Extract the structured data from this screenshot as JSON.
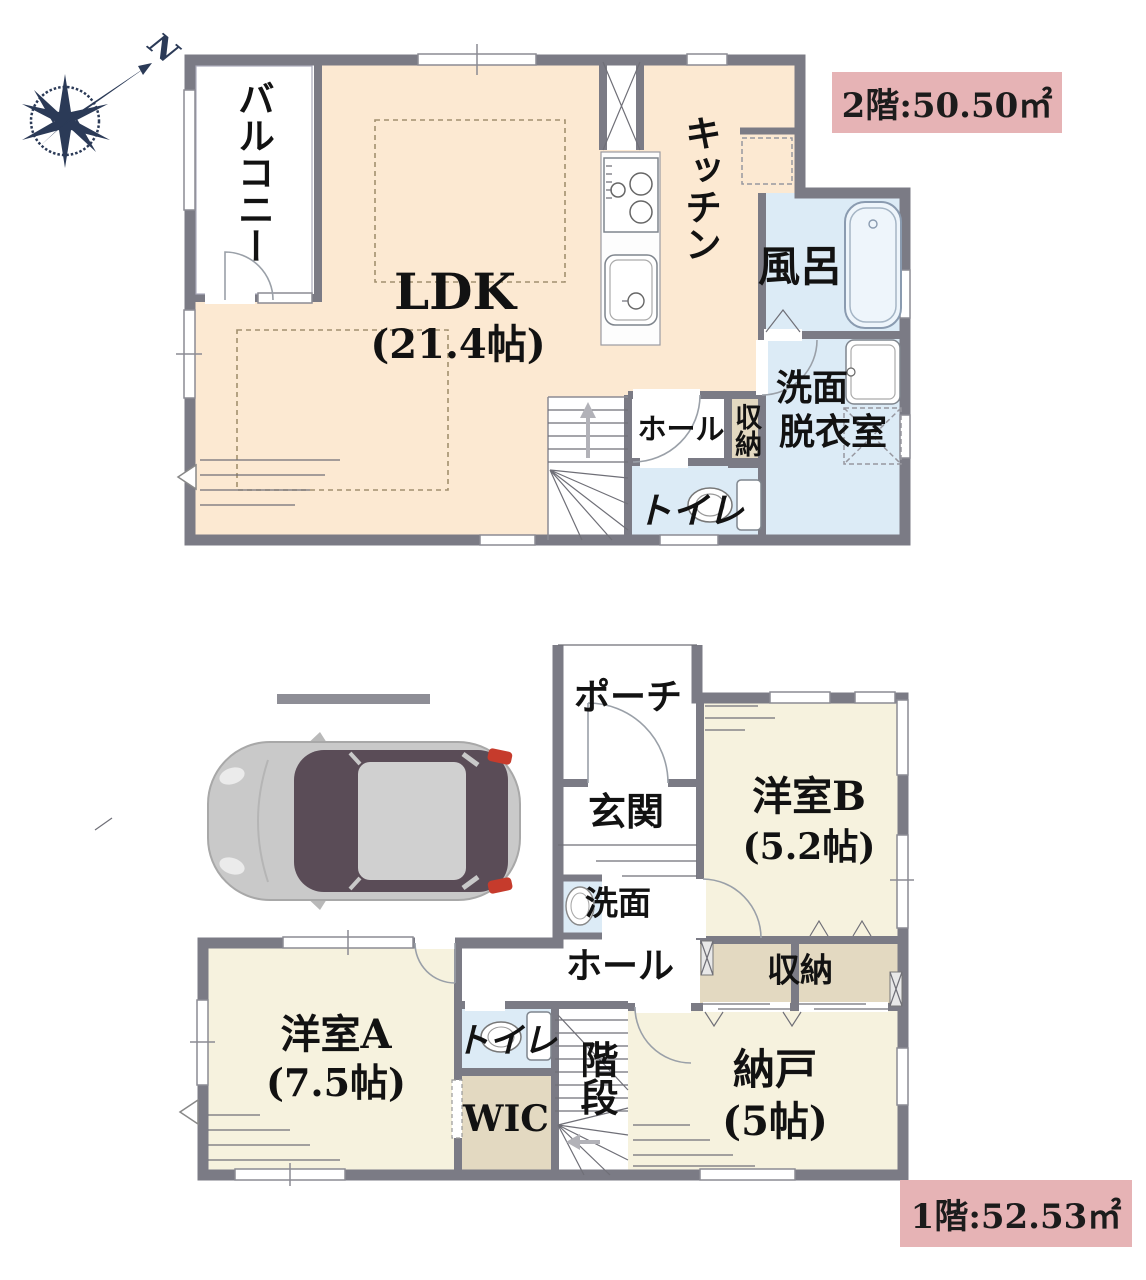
{
  "compass": {
    "north_label": "N"
  },
  "floor2": {
    "area_label": "2階:50.50㎡",
    "balcony": "バルコニー",
    "ldk": "LDK",
    "ldk_size": "(21.4帖)",
    "kitchen": "キッチン",
    "bath": "風呂",
    "washroom_line1": "洗面",
    "washroom_line2": "脱衣室",
    "hall": "ホール",
    "storage": "収納",
    "toilet": "トイレ"
  },
  "floor1": {
    "area_label": "1階:52.53㎡",
    "porch": "ポーチ",
    "entrance": "玄関",
    "washbasin": "洗面",
    "hall": "ホール",
    "room_b": "洋室B",
    "room_b_size": "(5.2帖)",
    "storage": "収納",
    "storeroom": "納戸",
    "storeroom_size": "(5帖)",
    "stairs": "階段",
    "toilet": "トイレ",
    "wic": "WIC",
    "room_a": "洋室A",
    "room_a_size": "(7.5帖)"
  },
  "colors": {
    "wall": "#7b7b85",
    "ldk_fill": "#fce9d2",
    "room_fill": "#f6f2de",
    "wet_fill": "#dcebf6",
    "closet_fill": "#e3d9c1",
    "area_label_bg": "#e6b3b5",
    "compass": "#2b3a57"
  }
}
